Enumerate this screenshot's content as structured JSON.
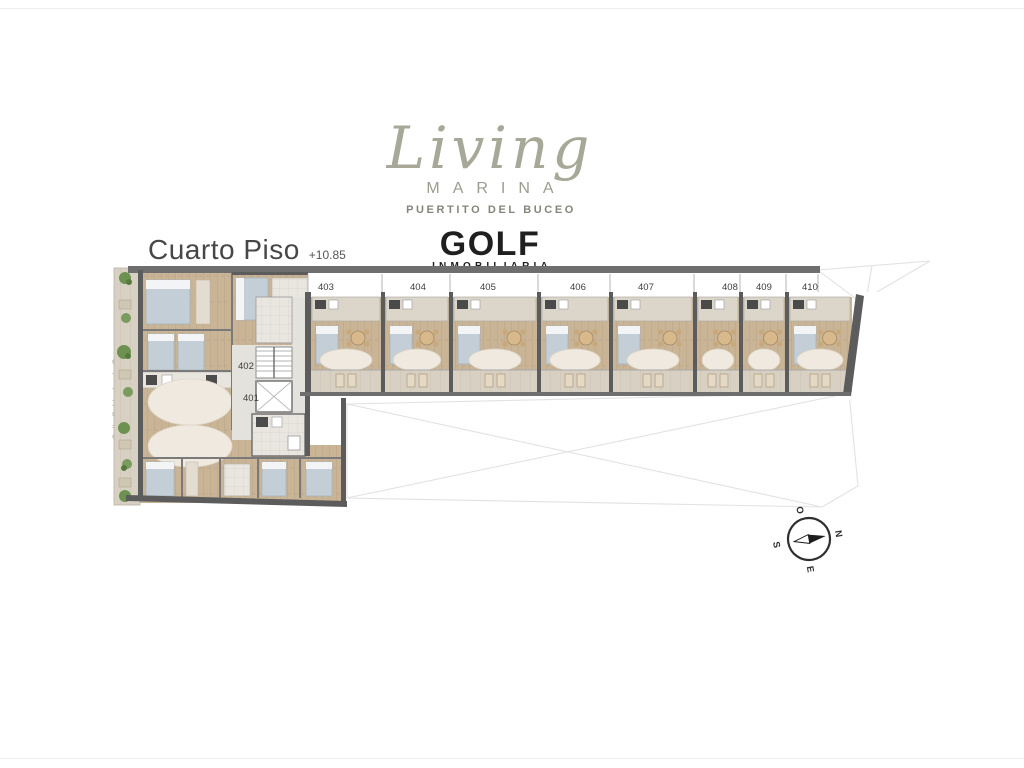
{
  "brand": {
    "name_script": "Living",
    "name_sub": "MARINA",
    "tagline": "PUERTITO DEL BUCEO",
    "agency": "GOLF",
    "agency_sub": "INMOBILIARIA"
  },
  "floor": {
    "title": "Cuarto Piso",
    "elevation": "+10.85"
  },
  "plan": {
    "street": "Calle Saldanha da Gama",
    "top_units": [
      "403",
      "404",
      "405",
      "406",
      "407",
      "408",
      "409",
      "410"
    ],
    "left_units": [
      "402",
      "401"
    ],
    "compass": {
      "north": "N",
      "east": "E",
      "south": "S",
      "west": "O"
    }
  },
  "colors": {
    "wall": "#5c5c5c",
    "wall_light": "#6e6e6e",
    "wood": "#c9b496",
    "wood_line": "#b7a185",
    "tile": "#e9e6e0",
    "bed": "#c3ced6",
    "rug": "#efe9df",
    "balcony": "#d8d1c3",
    "table": "#d7b98c",
    "plant": "#6d9150",
    "lot_line": "#e2e2e2",
    "logo_gray": "#a7a897",
    "ink": "#3d3d3d"
  }
}
